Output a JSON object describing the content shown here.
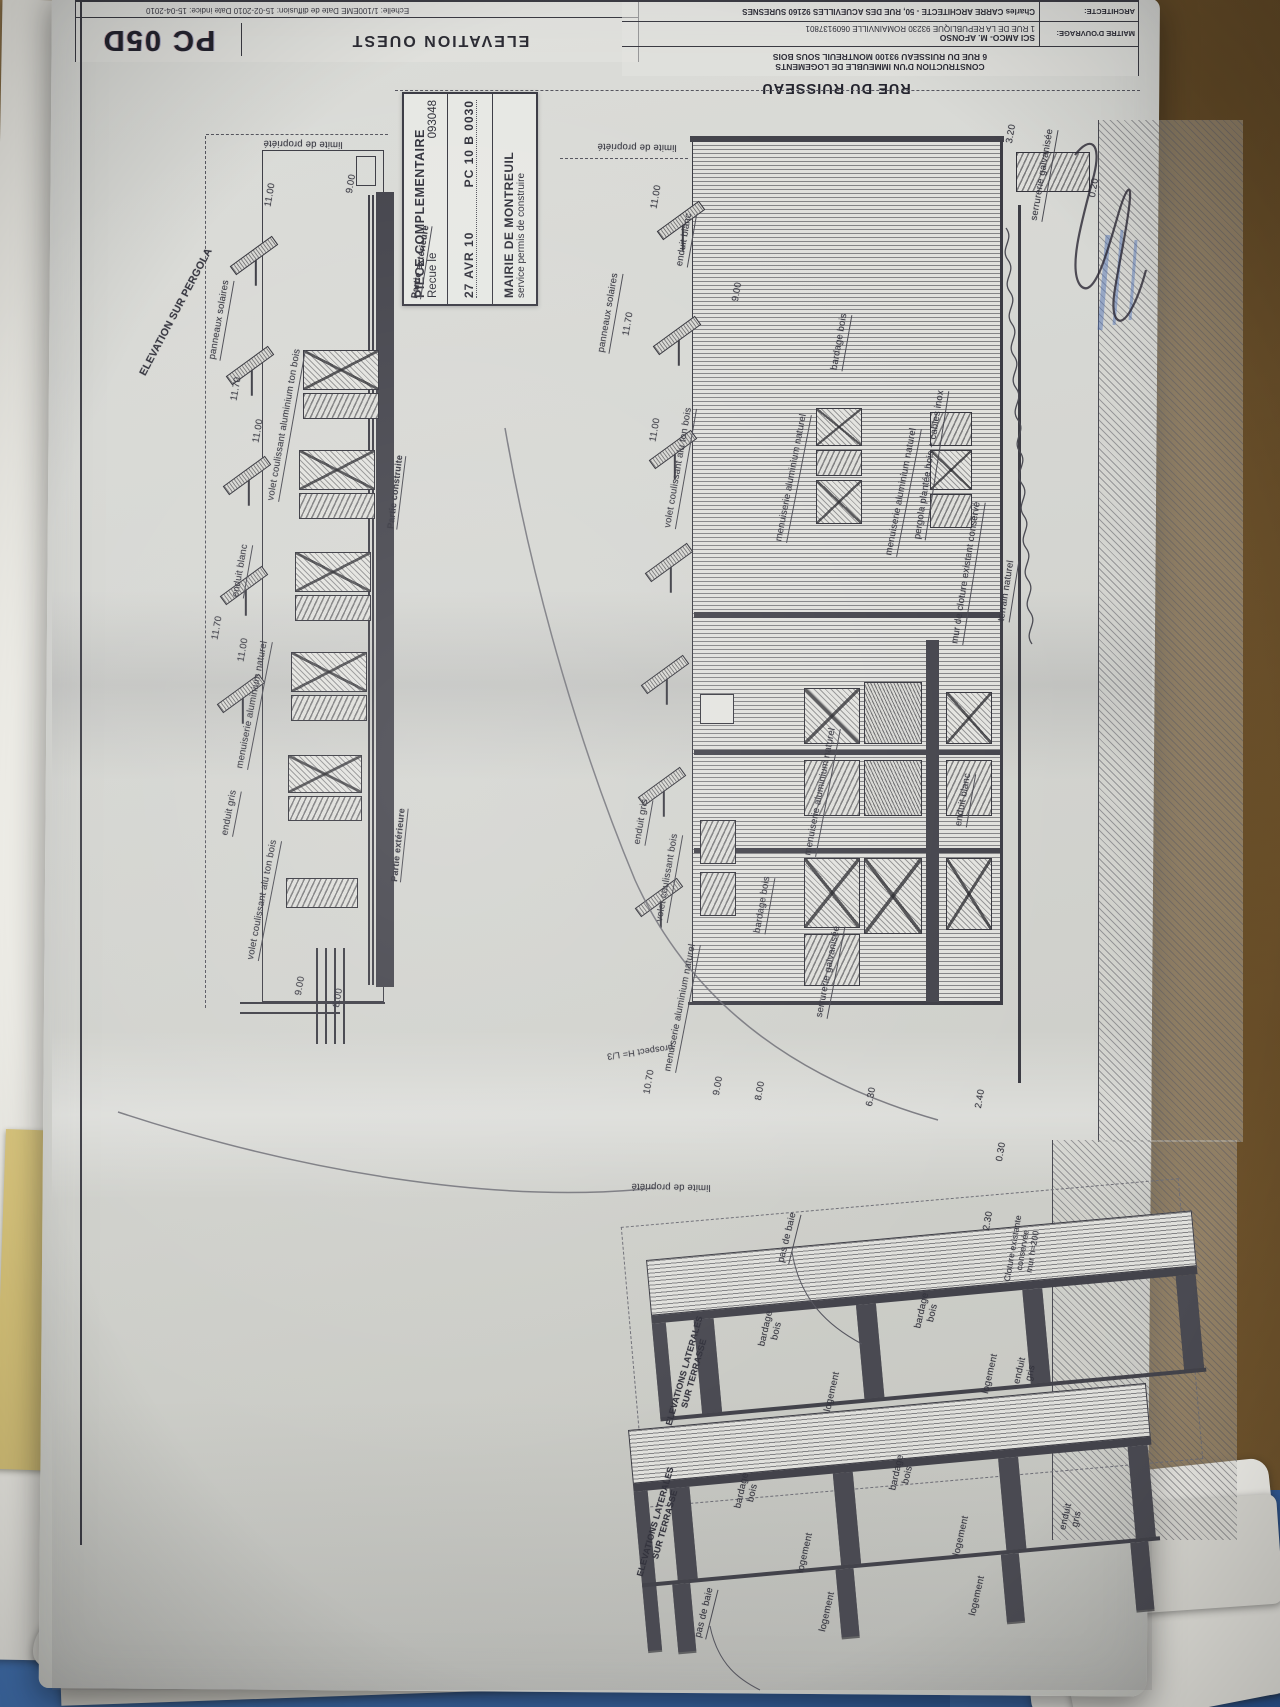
{
  "scene": {
    "street_label": "RUE DU RUISSEAU"
  },
  "title_block": {
    "doc_code": "PC 05D",
    "drawing_title": "ELEVATION OUEST",
    "dates_line": "Echelle: 1/100EME    Date de diffusion: 15-02-2010    Date indice: 15-04-2010",
    "project_line1": "CONSTRUCTION D'UN IMMEUBLE DE LOGEMENTS",
    "project_line2": "6 RUE DU RUISSEAU 93100 MONTREUIL SOUS BOIS",
    "maitre_label": "MAITRE D'OUVRAGE:",
    "maitre_name": "SCI AMCO- M. AFONSO",
    "maitre_address": "1 RUE DE LA REPUBLIQUE 93230 ROMAINVILLE 0609137801",
    "architecte_label": "ARCHITECTE:",
    "architecte_name": "Charles CARRE ARCHITECTE - 50, RUE DES ACUEVILLES 92160 SURESNES"
  },
  "stamp": {
    "line1": "PIECE COMPLEMENTAIRE",
    "recu_label": "Recue le",
    "recu_number": "093048",
    "date": "27 AVR 10",
    "ref": "PC 10 B 0030",
    "authority": "MAIRIE DE MONTREUIL",
    "service": "service permis de construire"
  },
  "annotations": [
    {
      "t": "ELEVATION SUR PERGOLA",
      "x": 176,
      "y": 312,
      "r": -62,
      "fs": 10.5,
      "b": 1
    },
    {
      "t": "limite de propriété",
      "x": 303,
      "y": 143,
      "r": 181
    },
    {
      "t": "11.00",
      "x": 271,
      "y": 195,
      "r": -80
    },
    {
      "t": "9.00",
      "x": 352,
      "y": 184,
      "r": -80
    },
    {
      "t": "panneaux solaires",
      "x": 221,
      "y": 320,
      "r": -80,
      "u": 1
    },
    {
      "t": "11.70",
      "x": 237,
      "y": 389,
      "r": -80
    },
    {
      "t": "volet coulissant aluminium ton bois",
      "x": 286,
      "y": 425,
      "r": -80,
      "u": 1
    },
    {
      "t": "11.00",
      "x": 259,
      "y": 431,
      "r": -80
    },
    {
      "t": "enduit blanc",
      "x": 242,
      "y": 571,
      "r": -80,
      "u": 1
    },
    {
      "t": "11.70",
      "x": 218,
      "y": 628,
      "r": -80
    },
    {
      "t": "11.00",
      "x": 244,
      "y": 650,
      "r": -80
    },
    {
      "t": "menuiserie aluminium naturel",
      "x": 254,
      "y": 705,
      "r": -79,
      "u": 1
    },
    {
      "t": "enduit gris",
      "x": 231,
      "y": 813,
      "r": -79,
      "u": 1
    },
    {
      "t": "volet coulissant alu ton bois",
      "x": 264,
      "y": 900,
      "r": -79,
      "u": 1
    },
    {
      "t": "Partie extérieure",
      "x": 421,
      "y": 262,
      "r": -81,
      "u": 1,
      "fs": 9,
      "b": 1
    },
    {
      "t": "Partie construite",
      "x": 396,
      "y": 492,
      "r": -83,
      "u": 1,
      "fs": 9,
      "b": 1
    },
    {
      "t": "Partie extérieure",
      "x": 399,
      "y": 845,
      "r": -84,
      "u": 1,
      "fs": 9,
      "b": 1
    },
    {
      "t": "9.00",
      "x": 301,
      "y": 986,
      "r": -80
    },
    {
      "t": "8.00",
      "x": 339,
      "y": 998,
      "r": -80
    },
    {
      "t": "limite de propriété",
      "x": 637,
      "y": 146,
      "r": 181
    },
    {
      "t": "11.00",
      "x": 657,
      "y": 197,
      "r": -80
    },
    {
      "t": "panneaux solaires",
      "x": 610,
      "y": 313,
      "r": -80,
      "u": 1
    },
    {
      "t": "11.70",
      "x": 629,
      "y": 324,
      "r": -80
    },
    {
      "t": "enduit blanc",
      "x": 686,
      "y": 240,
      "r": -80,
      "u": 1
    },
    {
      "t": "9.00",
      "x": 738,
      "y": 292,
      "r": -80
    },
    {
      "t": "11.00",
      "x": 656,
      "y": 430,
      "r": -80
    },
    {
      "t": "volet coulissant alu ton bois",
      "x": 680,
      "y": 468,
      "r": -80,
      "u": 1
    },
    {
      "t": "bardage bois",
      "x": 841,
      "y": 342,
      "r": -80,
      "u": 1
    },
    {
      "t": "menuiserie aluminium naturel",
      "x": 793,
      "y": 478,
      "r": -79,
      "u": 1
    },
    {
      "t": "menuiserie aluminium naturel",
      "x": 903,
      "y": 492,
      "r": -79,
      "u": 1
    },
    {
      "t": "serrurerie galvanisée",
      "x": 1044,
      "y": 175,
      "r": -80,
      "u": 1
    },
    {
      "t": "3.20",
      "x": 1012,
      "y": 134,
      "r": -80
    },
    {
      "t": "0.20",
      "x": 1095,
      "y": 188,
      "r": -80
    },
    {
      "t": "pergola plantée bois + cables inox",
      "x": 931,
      "y": 465,
      "r": -81,
      "u": 1
    },
    {
      "t": "mur de cloture existant conservé",
      "x": 968,
      "y": 573,
      "r": -81,
      "u": 1
    },
    {
      "t": "terrain naturel",
      "x": 1008,
      "y": 591,
      "r": -81,
      "u": 1
    },
    {
      "t": "enduit gris",
      "x": 643,
      "y": 822,
      "r": -80,
      "u": 1
    },
    {
      "t": "volet coulissant bois",
      "x": 669,
      "y": 878,
      "r": -80,
      "u": 1
    },
    {
      "t": "bardage bois",
      "x": 764,
      "y": 905,
      "r": -80,
      "u": 1
    },
    {
      "t": "menuiserie aluminium naturel",
      "x": 822,
      "y": 792,
      "r": -79,
      "u": 1
    },
    {
      "t": "serrurerie galvanisée",
      "x": 830,
      "y": 972,
      "r": -79,
      "u": 1
    },
    {
      "t": "menuiserie aluminium naturel",
      "x": 682,
      "y": 1008,
      "r": -79,
      "u": 1
    },
    {
      "t": "enduit blanc",
      "x": 965,
      "y": 800,
      "r": -80,
      "u": 1
    },
    {
      "t": "prospect H= L/3",
      "x": 640,
      "y": 1052,
      "r": 172,
      "fs": 9
    },
    {
      "t": "10.70",
      "x": 650,
      "y": 1082,
      "r": -80
    },
    {
      "t": "9.00",
      "x": 719,
      "y": 1086,
      "r": -80
    },
    {
      "t": "8.00",
      "x": 761,
      "y": 1091,
      "r": -80
    },
    {
      "t": "6.30",
      "x": 872,
      "y": 1097,
      "r": -80
    },
    {
      "t": "2.40",
      "x": 981,
      "y": 1099,
      "r": -80
    },
    {
      "t": "0.30",
      "x": 1002,
      "y": 1152,
      "r": -80
    },
    {
      "t": "limite de propriété",
      "x": 671,
      "y": 1186,
      "r": 181
    },
    {
      "t": "2.30",
      "x": 989,
      "y": 1221,
      "r": -80
    },
    {
      "t": "Cloture existante\nconservée\nmur h=200",
      "x": 1023,
      "y": 1250,
      "r": -80,
      "fs": 8.5
    },
    {
      "t": "pas de baie",
      "x": 789,
      "y": 1238,
      "r": -76,
      "u": 1
    },
    {
      "t": "ELEVATIONS LATERALES\nSUR TERRASSE",
      "x": 689,
      "y": 1372,
      "r": -74,
      "fs": 8.8,
      "b": 1
    },
    {
      "t": "bardage\nbois",
      "x": 772,
      "y": 1330,
      "r": -77
    },
    {
      "t": "bardage\nbois",
      "x": 928,
      "y": 1312,
      "r": -77
    },
    {
      "t": "enduit\ngris",
      "x": 1026,
      "y": 1372,
      "r": -77
    },
    {
      "t": "logement",
      "x": 833,
      "y": 1392,
      "r": -77
    },
    {
      "t": "logement",
      "x": 991,
      "y": 1374,
      "r": -77
    },
    {
      "t": "ELEVATIONS LATERALES\nSUR TERRASSE",
      "x": 660,
      "y": 1523,
      "r": -74,
      "fs": 8.8,
      "b": 1
    },
    {
      "t": "bardage\nbois",
      "x": 748,
      "y": 1492,
      "r": -77
    },
    {
      "t": "bardage\nbois",
      "x": 903,
      "y": 1474,
      "r": -77
    },
    {
      "t": "enduit\ngris",
      "x": 1072,
      "y": 1518,
      "r": -77
    },
    {
      "t": "logement",
      "x": 806,
      "y": 1553,
      "r": -77
    },
    {
      "t": "logement",
      "x": 962,
      "y": 1536,
      "r": -77
    },
    {
      "t": "logement",
      "x": 828,
      "y": 1612,
      "r": -77
    },
    {
      "t": "logement",
      "x": 978,
      "y": 1596,
      "r": -77
    },
    {
      "t": "pas de baie",
      "x": 706,
      "y": 1613,
      "r": -76,
      "u": 1
    }
  ],
  "graphics": {
    "lines": [
      {
        "k": "ln",
        "x": 80,
        "y": 0,
        "w": 2,
        "h": 1545
      },
      {
        "k": "dashv",
        "x": 205,
        "y": 136,
        "h": 872
      },
      {
        "k": "dash",
        "x": 206,
        "y": 134,
        "w": 182
      },
      {
        "k": "out",
        "x": 262,
        "y": 150,
        "w": 122,
        "h": 852
      },
      {
        "k": "band",
        "x": 376,
        "y": 192,
        "w": 18,
        "h": 795
      },
      {
        "k": "ln",
        "x": 368,
        "y": 195,
        "w": 2,
        "h": 790
      },
      {
        "k": "ln",
        "x": 372,
        "y": 195,
        "w": 2,
        "h": 790
      },
      {
        "k": "out",
        "x": 356,
        "y": 156,
        "w": 20,
        "h": 30
      },
      {
        "k": "ln",
        "x": 316,
        "y": 948,
        "w": 2,
        "h": 96
      },
      {
        "k": "ln",
        "x": 325,
        "y": 948,
        "w": 2,
        "h": 96
      },
      {
        "k": "ln",
        "x": 334,
        "y": 948,
        "w": 2,
        "h": 96
      },
      {
        "k": "ln",
        "x": 343,
        "y": 948,
        "w": 2,
        "h": 96
      },
      {
        "k": "ln",
        "x": 240,
        "y": 1002,
        "w": 145,
        "h": 2
      },
      {
        "k": "ln",
        "x": 240,
        "y": 1012,
        "w": 100,
        "h": 2
      },
      {
        "k": "dash",
        "x": 395,
        "y": 90,
        "w": 745
      },
      {
        "k": "dash",
        "x": 560,
        "y": 158,
        "w": 128
      },
      {
        "k": "sbH",
        "x": 692,
        "y": 140,
        "w": 310,
        "h": 862
      },
      {
        "k": "band",
        "x": 690,
        "y": 136,
        "w": 314,
        "h": 6
      },
      {
        "k": "ln",
        "x": 1000,
        "y": 140,
        "w": 3,
        "h": 865
      },
      {
        "k": "band",
        "x": 694,
        "y": 612,
        "w": 306,
        "h": 6
      },
      {
        "k": "band",
        "x": 694,
        "y": 750,
        "w": 306,
        "h": 5
      },
      {
        "k": "band",
        "x": 694,
        "y": 848,
        "w": 306,
        "h": 5
      },
      {
        "k": "band",
        "x": 926,
        "y": 640,
        "w": 13,
        "h": 362
      },
      {
        "k": "ln",
        "x": 1018,
        "y": 205,
        "w": 3,
        "h": 878
      },
      {
        "k": "hatch",
        "x": 1098,
        "y": 120,
        "w": 145,
        "h": 1022
      },
      {
        "k": "hatch",
        "x": 1052,
        "y": 1140,
        "w": 185,
        "h": 400
      },
      {
        "k": "ln",
        "x": 688,
        "y": 1002,
        "w": 315,
        "h": 3
      },
      {
        "k": "outd",
        "x": 632,
        "y": 1202,
        "w": 560,
        "h": 282,
        "r": -5
      }
    ],
    "windows": [
      {
        "k": "wx",
        "x": 303,
        "y": 350,
        "w": 76,
        "h": 40
      },
      {
        "k": "wd",
        "x": 303,
        "y": 393,
        "w": 76,
        "h": 26
      },
      {
        "k": "wx",
        "x": 299,
        "y": 450,
        "w": 76,
        "h": 40
      },
      {
        "k": "wd",
        "x": 299,
        "y": 493,
        "w": 76,
        "h": 26
      },
      {
        "k": "wx",
        "x": 295,
        "y": 552,
        "w": 76,
        "h": 40
      },
      {
        "k": "wd",
        "x": 295,
        "y": 595,
        "w": 76,
        "h": 26
      },
      {
        "k": "wx",
        "x": 291,
        "y": 652,
        "w": 76,
        "h": 40
      },
      {
        "k": "wd",
        "x": 291,
        "y": 695,
        "w": 76,
        "h": 26
      },
      {
        "k": "wx",
        "x": 288,
        "y": 755,
        "w": 74,
        "h": 38
      },
      {
        "k": "wd",
        "x": 288,
        "y": 796,
        "w": 74,
        "h": 25
      },
      {
        "k": "wd",
        "x": 286,
        "y": 878,
        "w": 72,
        "h": 30
      },
      {
        "k": "wx",
        "x": 816,
        "y": 408,
        "w": 46,
        "h": 38
      },
      {
        "k": "wd",
        "x": 816,
        "y": 450,
        "w": 46,
        "h": 26
      },
      {
        "k": "wx",
        "x": 816,
        "y": 480,
        "w": 46,
        "h": 44
      },
      {
        "k": "wd",
        "x": 930,
        "y": 412,
        "w": 42,
        "h": 34
      },
      {
        "k": "wx",
        "x": 930,
        "y": 450,
        "w": 42,
        "h": 40
      },
      {
        "k": "wd",
        "x": 930,
        "y": 494,
        "w": 42,
        "h": 34
      },
      {
        "k": "wx",
        "x": 804,
        "y": 688,
        "w": 56,
        "h": 56
      },
      {
        "k": "wd",
        "x": 804,
        "y": 760,
        "w": 56,
        "h": 56
      },
      {
        "k": "wx",
        "x": 804,
        "y": 858,
        "w": 56,
        "h": 70
      },
      {
        "k": "wd",
        "x": 804,
        "y": 934,
        "w": 56,
        "h": 52
      },
      {
        "k": "wdd",
        "x": 864,
        "y": 682,
        "w": 58,
        "h": 62
      },
      {
        "k": "wdd",
        "x": 864,
        "y": 760,
        "w": 58,
        "h": 56
      },
      {
        "k": "wx",
        "x": 864,
        "y": 858,
        "w": 58,
        "h": 76
      },
      {
        "k": "wx",
        "x": 946,
        "y": 692,
        "w": 46,
        "h": 52
      },
      {
        "k": "wd",
        "x": 946,
        "y": 760,
        "w": 46,
        "h": 56
      },
      {
        "k": "wx",
        "x": 946,
        "y": 858,
        "w": 46,
        "h": 72
      },
      {
        "k": "wd",
        "x": 700,
        "y": 820,
        "w": 36,
        "h": 44
      },
      {
        "k": "wd",
        "x": 700,
        "y": 872,
        "w": 36,
        "h": 44
      },
      {
        "k": "wo",
        "x": 700,
        "y": 694,
        "w": 34,
        "h": 30
      },
      {
        "k": "wd",
        "x": 1016,
        "y": 152,
        "w": 74,
        "h": 40
      }
    ],
    "panels": [
      {
        "k": "panel",
        "x": 228,
        "y": 250,
        "r": -36
      },
      {
        "k": "panel",
        "x": 224,
        "y": 360,
        "r": -36
      },
      {
        "k": "panel",
        "x": 221,
        "y": 470,
        "r": -36
      },
      {
        "k": "panel",
        "x": 218,
        "y": 580,
        "r": -36
      },
      {
        "k": "panel",
        "x": 215,
        "y": 688,
        "r": -36
      },
      {
        "k": "panel",
        "x": 655,
        "y": 215,
        "r": -36
      },
      {
        "k": "panel",
        "x": 651,
        "y": 330,
        "r": -36
      },
      {
        "k": "panel",
        "x": 647,
        "y": 444,
        "r": -36
      },
      {
        "k": "panel",
        "x": 643,
        "y": 557,
        "r": -36
      },
      {
        "k": "panel",
        "x": 639,
        "y": 669,
        "r": -36
      },
      {
        "k": "panel",
        "x": 636,
        "y": 781,
        "r": -36
      },
      {
        "k": "panel",
        "x": 633,
        "y": 892,
        "r": -36
      }
    ],
    "strips": {
      "s1": [
        {
          "k": "sbH",
          "x": 0,
          "y": 0,
          "w": 548,
          "h": 56
        },
        {
          "k": "band",
          "x": 0,
          "y": 56,
          "w": 548,
          "h": 8
        },
        {
          "k": "pier",
          "x": 0,
          "y": 64,
          "w": 14,
          "h": 96
        },
        {
          "k": "pier",
          "x": 42,
          "y": 64,
          "w": 20,
          "h": 94
        },
        {
          "k": "pier",
          "x": 205,
          "y": 64,
          "w": 20,
          "h": 94
        },
        {
          "k": "pier",
          "x": 372,
          "y": 64,
          "w": 20,
          "h": 94
        },
        {
          "k": "pier",
          "x": 526,
          "y": 64,
          "w": 20,
          "h": 94
        },
        {
          "k": "band",
          "x": 0,
          "y": 158,
          "w": 548,
          "h": 4
        }
      ],
      "s2": [
        {
          "k": "sbH",
          "x": 0,
          "y": 0,
          "w": 520,
          "h": 54
        },
        {
          "k": "band",
          "x": 0,
          "y": 54,
          "w": 520,
          "h": 8
        },
        {
          "k": "pier",
          "x": 0,
          "y": 62,
          "w": 14,
          "h": 160
        },
        {
          "k": "pier",
          "x": 36,
          "y": 62,
          "w": 20,
          "h": 92
        },
        {
          "k": "pier",
          "x": 200,
          "y": 62,
          "w": 20,
          "h": 92
        },
        {
          "k": "pier",
          "x": 366,
          "y": 62,
          "w": 20,
          "h": 92
        },
        {
          "k": "pier",
          "x": 496,
          "y": 62,
          "w": 20,
          "h": 92
        },
        {
          "k": "band",
          "x": 0,
          "y": 154,
          "w": 520,
          "h": 4
        },
        {
          "k": "pier",
          "x": 30,
          "y": 158,
          "w": 18,
          "h": 68
        },
        {
          "k": "pier",
          "x": 194,
          "y": 158,
          "w": 18,
          "h": 68
        },
        {
          "k": "pier",
          "x": 360,
          "y": 158,
          "w": 18,
          "h": 68
        },
        {
          "k": "pier",
          "x": 490,
          "y": 158,
          "w": 18,
          "h": 68
        }
      ]
    }
  }
}
